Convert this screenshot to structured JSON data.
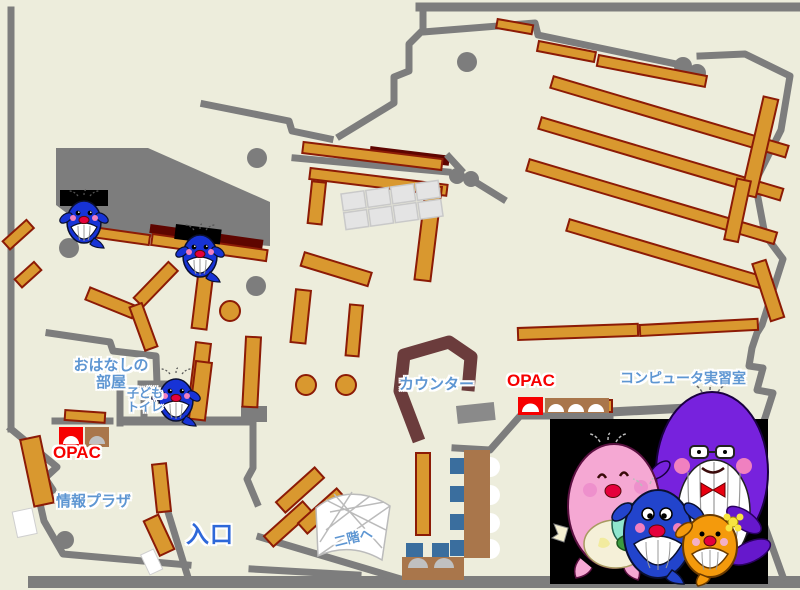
{
  "labels": {
    "ohanashi_room_line1": "おはなしの",
    "ohanashi_room_line2": "部屋",
    "kids_toilet_line1": "子ども",
    "kids_toilet_line2": "トイレ",
    "opac_left": "OPAC",
    "opac_right": "OPAC",
    "joho_plaza": "情報プラザ",
    "entrance": "入口",
    "counter": "カウンター",
    "computer_room": "コンピュータ実習室",
    "to_second_floor": "二階へ"
  },
  "colors": {
    "floor": "#EDEDDC",
    "wall": "#7D7D7D",
    "shelf": "#D9982F",
    "shelf_border": "#8C1B06",
    "dark_red": "#5E0500",
    "counter": "#6B3C3C",
    "table_brown": "#A9764B",
    "chair_blue": "#3A6E9E",
    "seat_gray": "#C0C0C0",
    "opac_red": "#F60000",
    "label_blue": "#5E96D2",
    "entrance_blue": "#2E68D9",
    "stairs_line": "#BBBBBB",
    "photo_bg": "#000000",
    "whale_blue": "#1733D6",
    "mama_pink": "#F5A8D3",
    "papa_purple": "#7722DD",
    "kid_blue": "#2244CC",
    "kid_orange": "#F49A0C",
    "baby_teal": "#8FE5CE",
    "fin_purple": "#6618CC",
    "flower_yellow": "#F7E340",
    "cheek_pink": "#F080C0",
    "mouth_red": "#E5003C"
  }
}
